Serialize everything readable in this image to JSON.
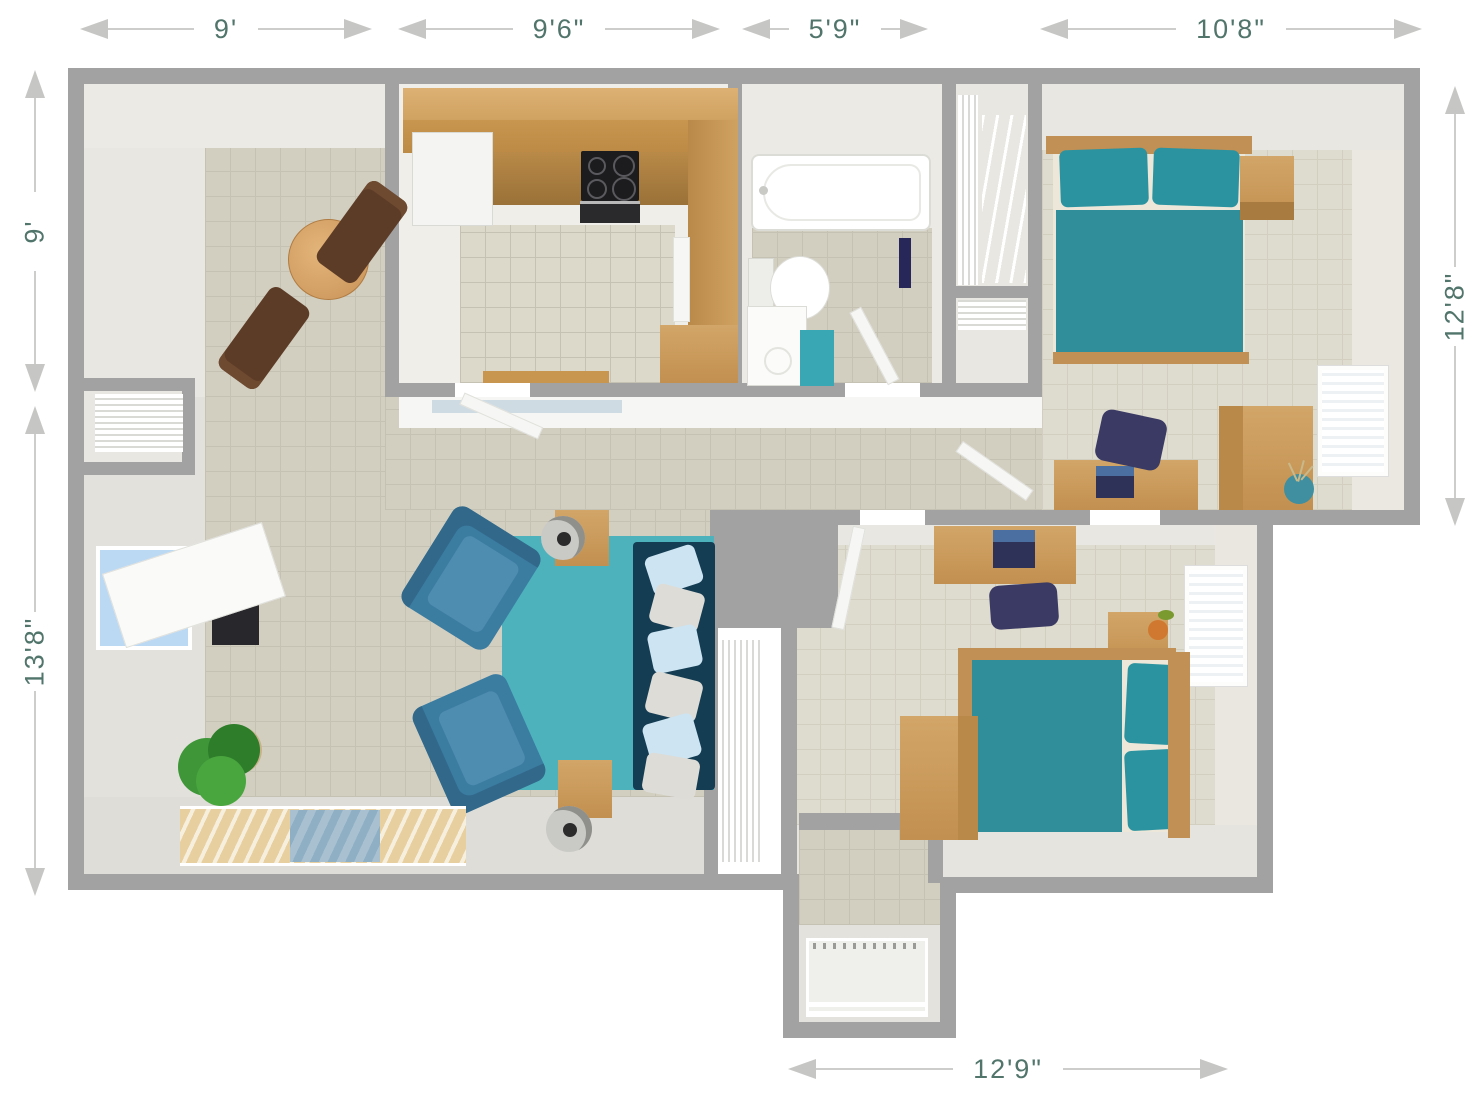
{
  "plan": {
    "dimensions": {
      "top": [
        {
          "label": "9'"
        },
        {
          "label": "9'6\""
        },
        {
          "label": "5'9\""
        },
        {
          "label": "10'8\""
        }
      ],
      "left": [
        {
          "label": "9'"
        },
        {
          "label": "13'8\""
        }
      ],
      "right": [
        {
          "label": "12'8\""
        }
      ],
      "bottom": [
        {
          "label": "12'9\""
        }
      ]
    },
    "palette": {
      "wall_gray": "#a2a2a2",
      "floor_tile": "#d2cfc0",
      "floor_tile_light": "#dedbcf",
      "wall_face_light": "#e8e7e1",
      "dimension_text": "#51756b",
      "dimension_line": "#c9c9c7",
      "bed_teal": "#2f8e9a",
      "pillow_teal": "#2b93a0",
      "rug_teal": "#4db2bc",
      "sofa_navy": "#143d54",
      "armchair_blue": "#3b7ca1",
      "wood": "#c89a58",
      "wood_dark": "#9a7138",
      "dining_chair_brown": "#5d3c27",
      "desk_chair_navy": "#3a3a64",
      "bathmat_teal": "#3aa7b5",
      "window_blue": "#bcd9f4",
      "plant_green": "#3e9638",
      "appliance_black": "#1c1c1e",
      "laptop_navy": "#2e3158"
    }
  }
}
